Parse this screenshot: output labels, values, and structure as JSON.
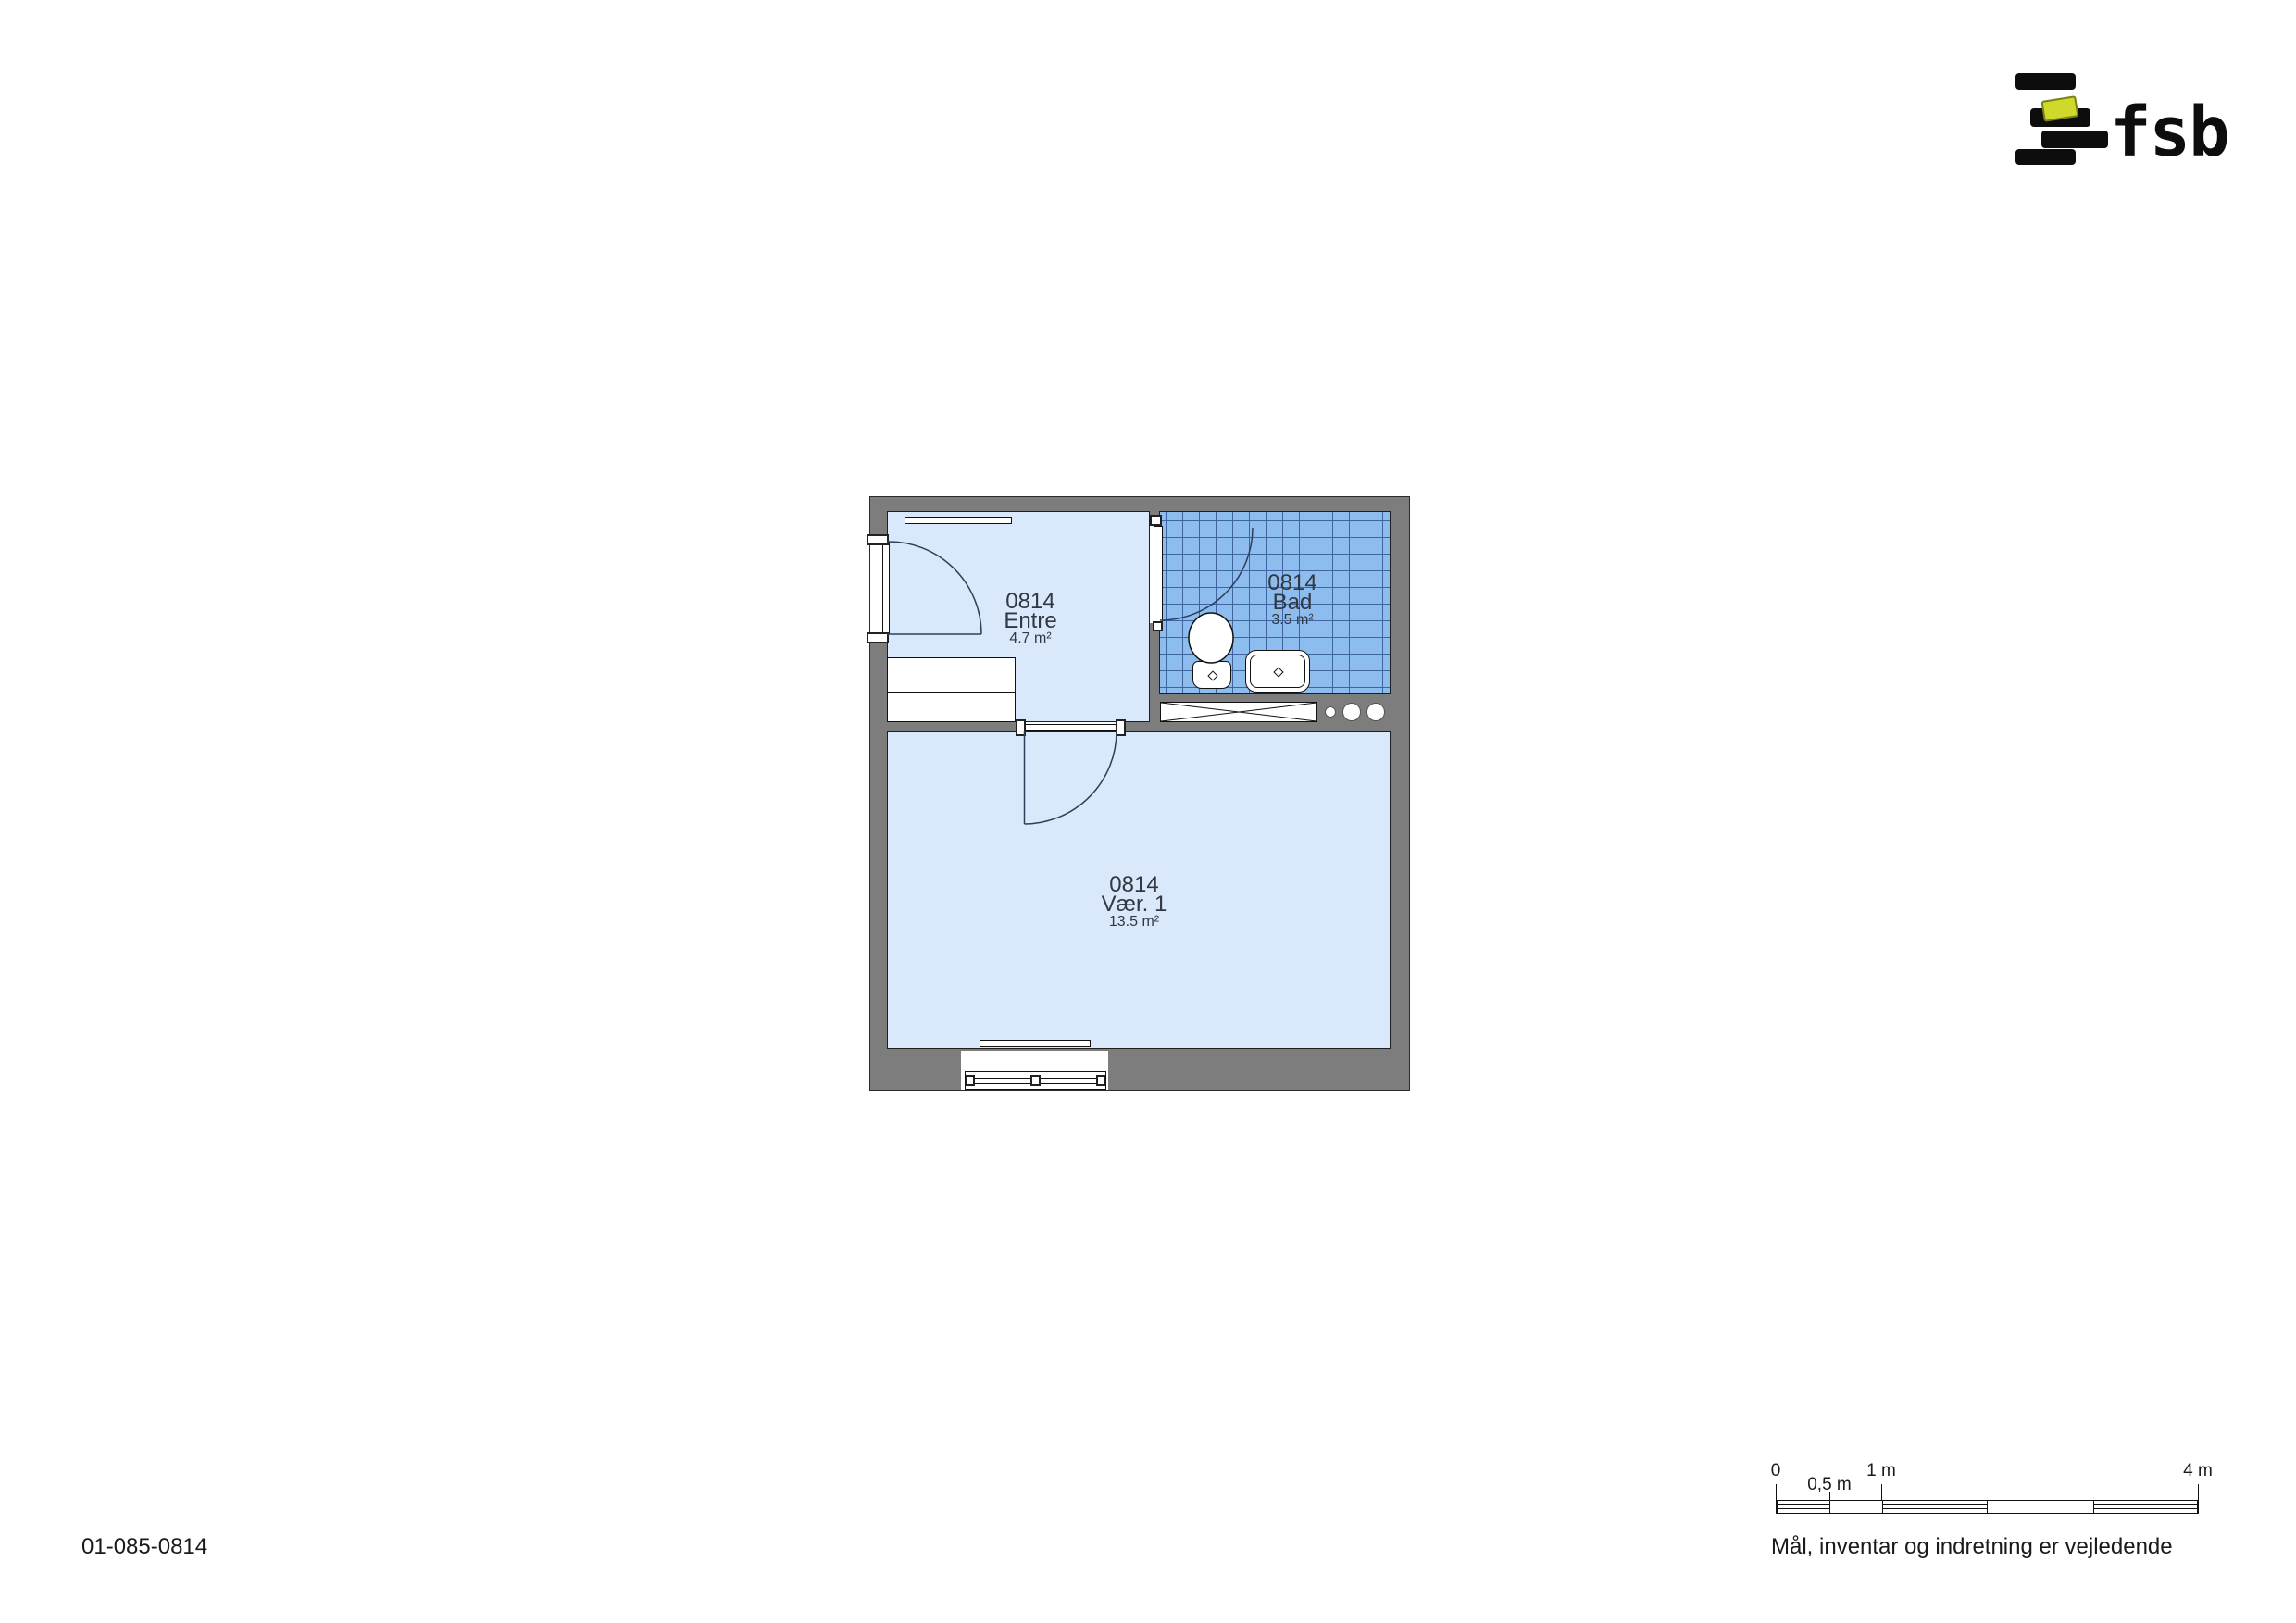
{
  "logo": {
    "text": "fsb",
    "accent_color": "#cfd92b",
    "bar_color": "#0d0d0d"
  },
  "plan": {
    "unit_id": "0814",
    "wall_color": "#7d7d7d",
    "room_fill": "#d9e9fb",
    "bath_tile_fill": "#8cbdee",
    "bath_tile_line": "#3f64a0",
    "rooms": [
      {
        "id": "0814",
        "name": "Entre",
        "area": "4.7 m²"
      },
      {
        "id": "0814",
        "name": "Bad",
        "area": "3.5 m²"
      },
      {
        "id": "0814",
        "name": "Vær. 1",
        "area": "13.5 m²"
      }
    ],
    "fixtures": [
      "entrance-door",
      "bath-door",
      "room-door",
      "wardrobe",
      "shelf",
      "toilet",
      "sink",
      "vent-shaft",
      "pipe-risers",
      "radiator",
      "window"
    ]
  },
  "scalebar": {
    "labels": [
      "0",
      "0,5 m",
      "1 m",
      "4 m"
    ]
  },
  "footer": {
    "drawing_number": "01-085-0814",
    "disclaimer": "Mål, inventar og indretning er vejledende"
  }
}
